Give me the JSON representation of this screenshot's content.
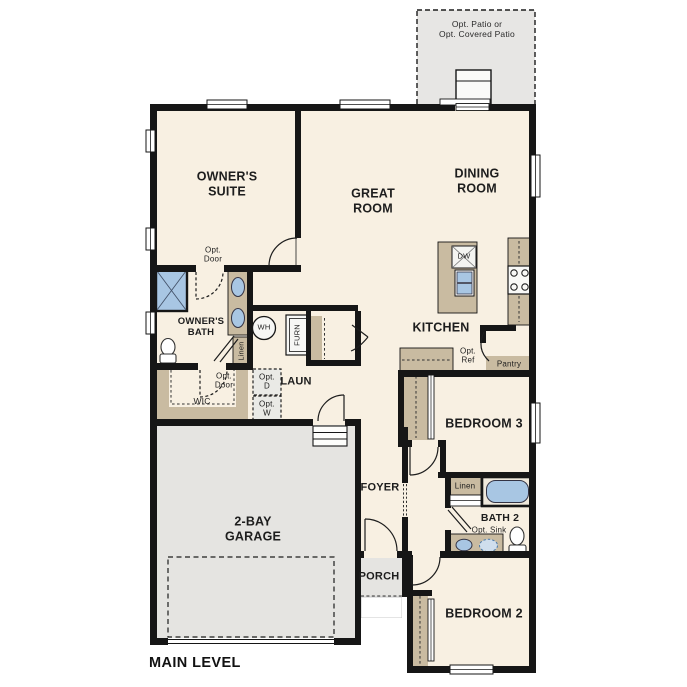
{
  "title": "MAIN LEVEL",
  "labels": {
    "patio": "Opt. Patio or\nOpt. Covered Patio",
    "owners_suite": "OWNER'S\nSUITE",
    "great_room": "GREAT\nROOM",
    "dining_room": "DINING\nROOM",
    "kitchen": "KITCHEN",
    "owners_bath": "OWNER'S\nBATH",
    "opt_door_suite": "Opt.\nDoor",
    "opt_door_wic": "Opt.\nDoor",
    "wic": "WIC",
    "linen_owners": "Linen",
    "wh": "WH",
    "furn": "FURN",
    "opt_dryer": "Opt.\nD",
    "opt_washer": "Opt.\nW",
    "laundry": "LAUN",
    "foyer": "FOYER",
    "porch": "PORCH",
    "garage": "2-BAY\nGARAGE",
    "bedroom3": "BEDROOM 3",
    "bedroom2": "BEDROOM 2",
    "bath2": "BATH 2",
    "opt_sink": "Opt. Sink",
    "linen_bath2": "Linen",
    "pantry": "Pantry",
    "opt_ref": "Opt.\nRef",
    "dishwasher": "DW"
  },
  "colors": {
    "floor": "#f8f0e2",
    "outdoor_concrete": "#e5e4e1",
    "cabinetry": "#c9bba1",
    "wall": "#161616",
    "fixture_blue": "#a8c6e3",
    "optional_fill": "#eaeae6"
  }
}
